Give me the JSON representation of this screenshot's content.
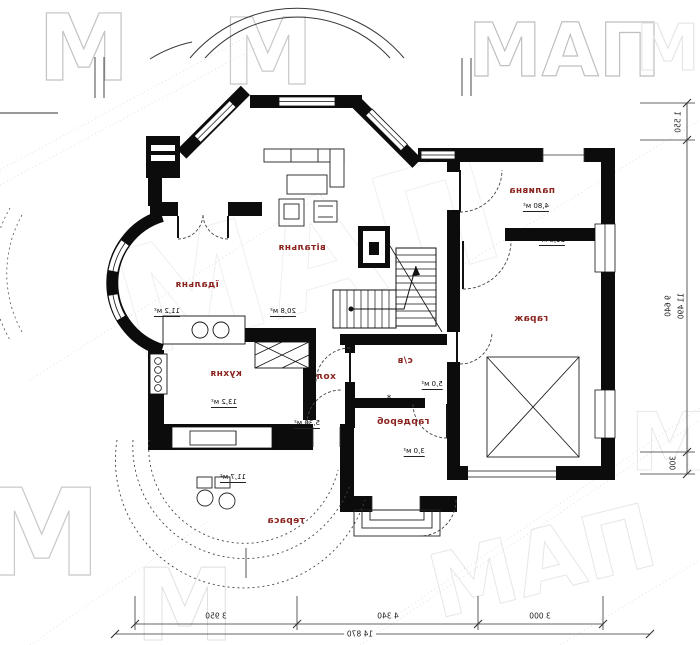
{
  "plan": {
    "rooms": [
      {
        "name": "вітальня",
        "area": "20,8 м²"
      },
      {
        "name": "їдальня",
        "area": "11,2 м²"
      },
      {
        "name": "кухня",
        "area": "13,2 м²"
      },
      {
        "name": "хол",
        "area": "5,30 м²"
      },
      {
        "name": "с/в",
        "area": "5,0 м²"
      },
      {
        "name": "гардероб",
        "area": "3,0 м²"
      },
      {
        "name": "паливна",
        "area": "4,80 м²"
      },
      {
        "name": "гараж",
        "area": "21,8 м²"
      },
      {
        "name": "тераса",
        "area": "11,7 м²"
      }
    ]
  },
  "dimensions": {
    "bottom": {
      "segments": [
        "3 950",
        "4 340",
        "3 000"
      ],
      "total": "14 870"
    },
    "right": {
      "segments": [
        "1 550",
        "9 640",
        "300"
      ],
      "total": "11 490"
    }
  },
  "annotations": {
    "star": "*"
  },
  "watermark": {
    "text": "МАП",
    "letter": "М"
  },
  "colors": {
    "room_label": "#8a241f",
    "walls": "#0c0c0c",
    "watermark_light": "#e6e6e6"
  }
}
